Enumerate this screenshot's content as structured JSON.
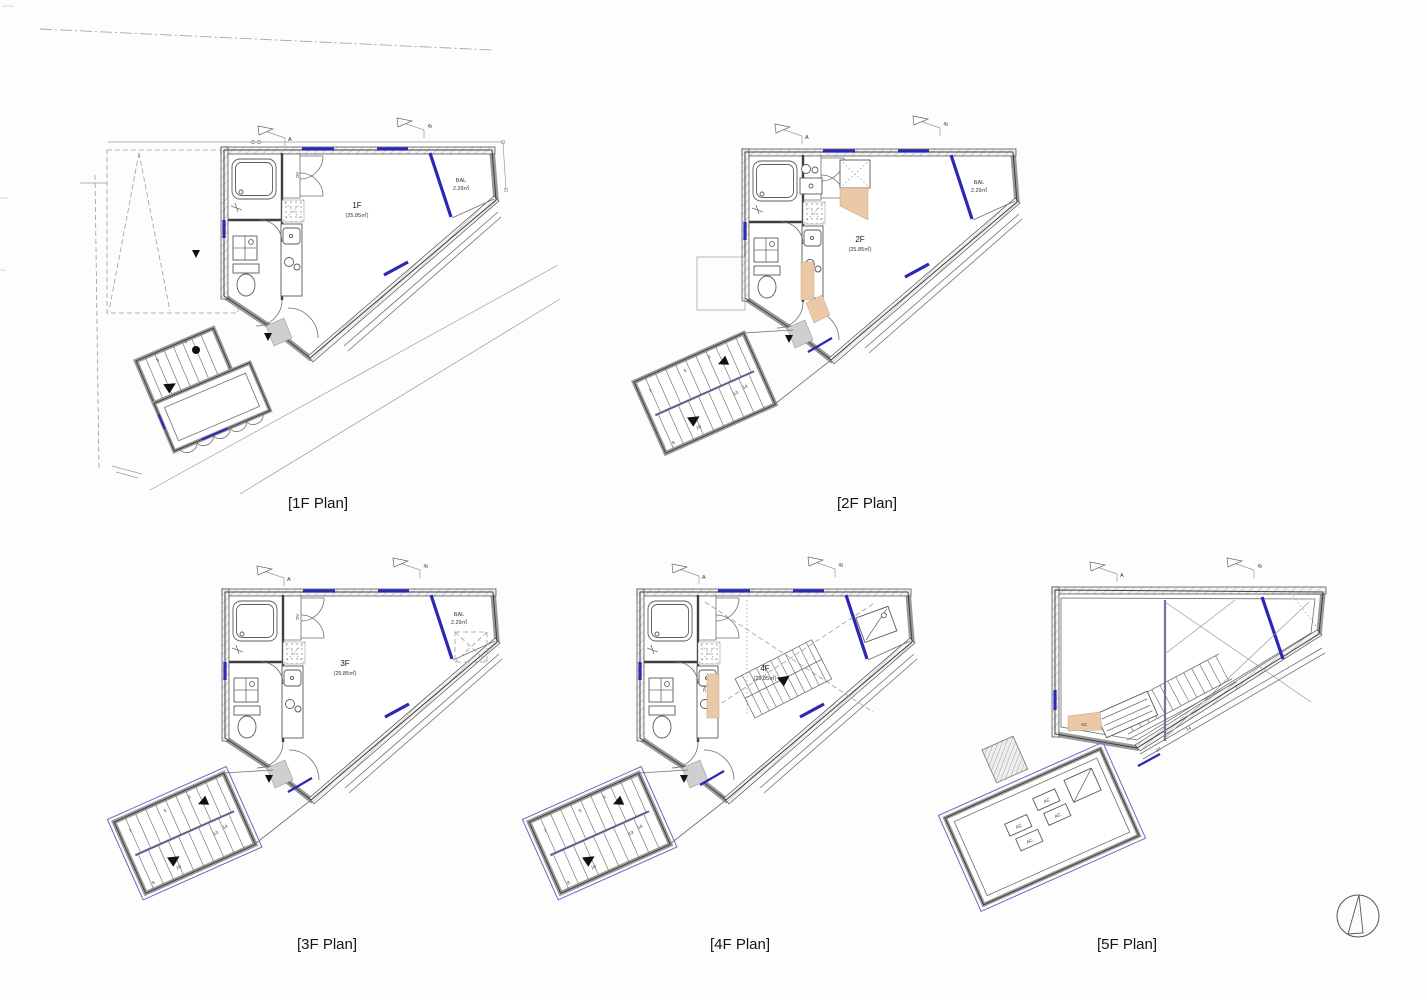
{
  "sheet": {
    "background_color": "#fdfdfd",
    "type": "architectural floor plan sheet",
    "floors_shown": 5
  },
  "colors": {
    "wall_edge": "#3f3f3f",
    "wall_grey": "#9a9a9a",
    "window_blue": "#2a28b4",
    "glass_outline_blue": "#6b69c8",
    "handrail_blue": "#7d7db5",
    "wood_tan": "#ecc9a6",
    "entry_mat_grey": "#cfcfcf",
    "site_line_grey": "#9a9a9a"
  },
  "symbols": {
    "north_arrow": "compass-north-arrow",
    "section_flag": "section-cut-flag",
    "entry_arrow": "entrance-direction-triangle"
  },
  "plans": {
    "f1": {
      "caption": "[1F Plan]",
      "room_label": "1F",
      "room_area": "(25.85㎡)",
      "balcony_label": "BAL",
      "balcony_area": "2.29㎡",
      "closet_label": "AC",
      "section_marker_a": "A",
      "section_marker_b": "B",
      "stair_numbers": {
        "s1": "1",
        "s5": "5"
      }
    },
    "f2": {
      "caption": "[2F Plan]",
      "room_label": "2F",
      "room_area": "(25.85㎡)",
      "balcony_label": "BAL",
      "balcony_area": "2.29㎡",
      "section_marker_a": "A",
      "section_marker_b": "B",
      "stair_numbers": {
        "s1": "1",
        "s5": "5",
        "s7": "7",
        "s8": "8",
        "s10": "10",
        "s13": "13",
        "s14": "14"
      }
    },
    "f3": {
      "caption": "[3F Plan]",
      "room_label": "3F",
      "room_area": "(25.85㎡)",
      "balcony_label": "BAL",
      "balcony_area": "2.29㎡",
      "closet_label": "AC",
      "section_marker_a": "A",
      "section_marker_b": "B",
      "stair_numbers": {
        "s1": "1",
        "s5": "5",
        "s7": "7",
        "s8": "8",
        "s10": "10",
        "s13": "13",
        "s14": "14"
      }
    },
    "f4": {
      "caption": "[4F Plan]",
      "room_label": "4F",
      "room_area": "(25.85㎡)",
      "closet_label": "AC",
      "section_marker_a": "A",
      "section_marker_b": "B",
      "stair_numbers": {
        "s1": "1",
        "s5": "5",
        "s7": "7",
        "s8": "8",
        "s10": "10",
        "s13": "13",
        "s14": "14"
      }
    },
    "f5": {
      "caption": "[5F Plan]",
      "ac_label": "AC",
      "section_marker_a": "A",
      "section_marker_b": "B",
      "stair_numbers": {
        "s7": "7",
        "s14": "14",
        "s17": "17"
      }
    }
  }
}
